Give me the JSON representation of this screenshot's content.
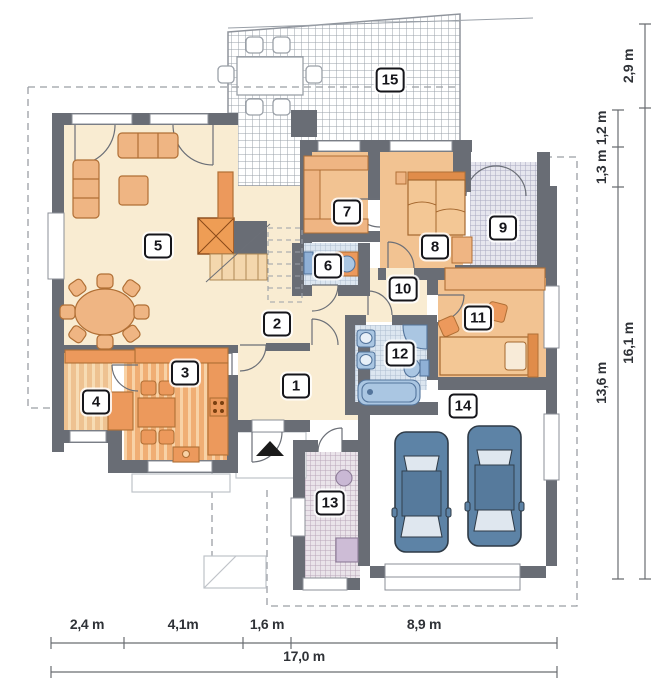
{
  "plan": {
    "unit": "m",
    "rooms": [
      {
        "number": "1"
      },
      {
        "number": "2"
      },
      {
        "number": "3"
      },
      {
        "number": "4"
      },
      {
        "number": "5"
      },
      {
        "number": "6"
      },
      {
        "number": "7"
      },
      {
        "number": "8"
      },
      {
        "number": "9"
      },
      {
        "number": "10"
      },
      {
        "number": "11"
      },
      {
        "number": "12"
      },
      {
        "number": "13"
      },
      {
        "number": "14"
      },
      {
        "number": "15"
      }
    ],
    "dims": {
      "bottom": [
        {
          "label": "2,4 m"
        },
        {
          "label": "4,1m"
        },
        {
          "label": "1,6 m"
        },
        {
          "label": "8,9 m"
        }
      ],
      "bottom_total": {
        "label": "17,0 m"
      },
      "right_outer": [
        {
          "label": "2,9 m"
        },
        {
          "label": "16,1 m"
        }
      ],
      "right_inner": [
        {
          "label": "1,2 m"
        },
        {
          "label": "1,3 m"
        },
        {
          "label": "13,6 m"
        }
      ]
    },
    "icons": {
      "entrance_marker": "entrance-arrow"
    },
    "colors": {
      "wall": "#696d75",
      "floor_light": "#f9ecd2",
      "floor_tan": "#f2c392",
      "furniture": "#efb583",
      "furniture_dark": "#ec995c",
      "tile_blue": "#dce6f0",
      "fixture_blue": "#aac6e2",
      "fixture_stroke": "#54759c",
      "car_body": "#5d83a6",
      "label_border": "#15151a",
      "dimension_text": "#2f3237"
    }
  }
}
